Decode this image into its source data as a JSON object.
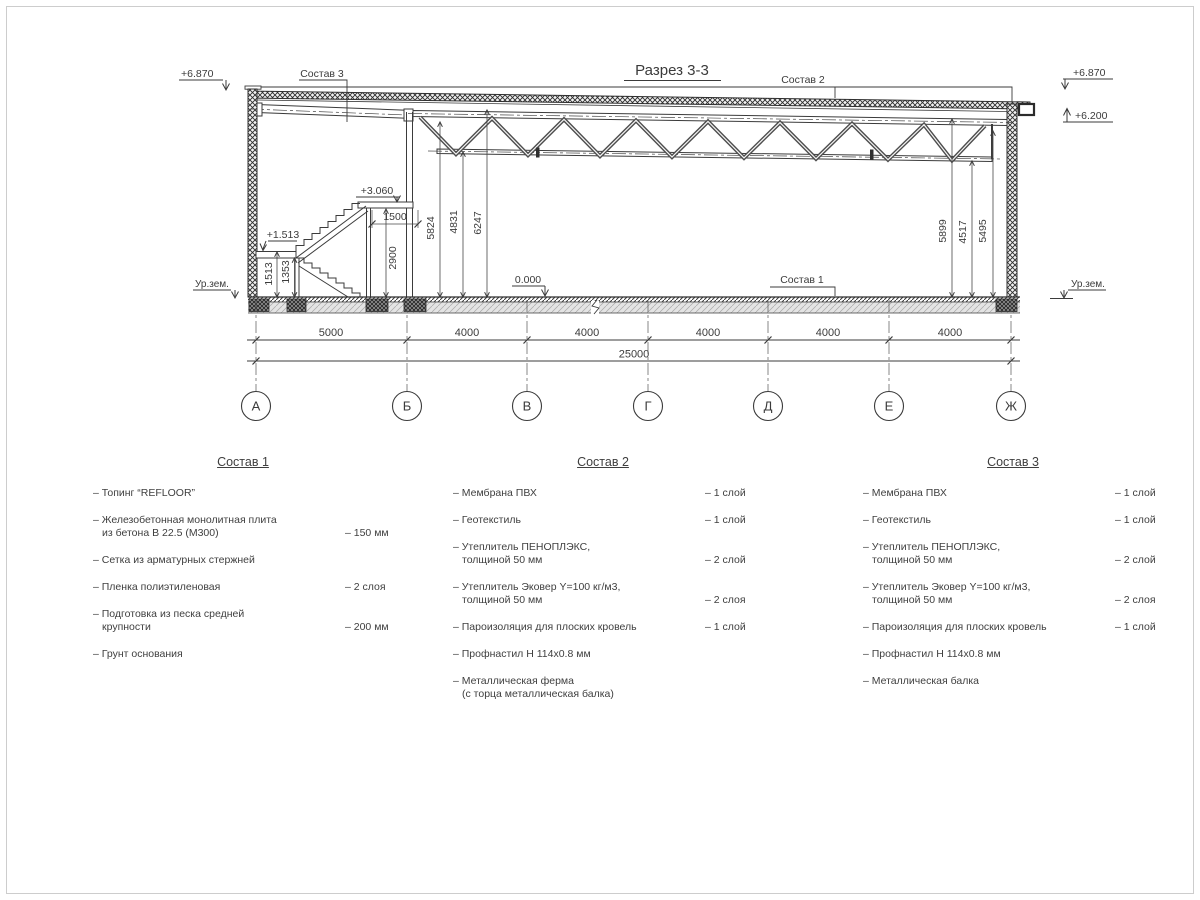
{
  "drawing": {
    "title": "Разрез 3-3",
    "elev_left_top": "+6.870",
    "elev_right_top": "+6.870",
    "elev_right_low": "+6.200",
    "elev_mezzanine": "+3.060",
    "elev_landing": "+1.513",
    "elev_floor": "0.000",
    "ground_label_left": "Ур.зем.",
    "ground_label_right": "Ур.зем.",
    "leader1": "Состав 1",
    "leader2": "Состав 2",
    "leader3": "Состав 3",
    "dim_1513": "1513",
    "dim_1353": "1353",
    "dim_2900": "2900",
    "dim_1500": "1500",
    "dim_5824": "5824",
    "dim_4831": "4831",
    "dim_6247": "6247",
    "dim_5899": "5899",
    "dim_4517": "4517",
    "dim_5495": "5495",
    "span_dims": [
      "5000",
      "4000",
      "4000",
      "4000",
      "4000",
      "4000"
    ],
    "total_dim": "25000",
    "axes": [
      "А",
      "Б",
      "В",
      "Г",
      "Д",
      "Е",
      "Ж"
    ]
  },
  "specs": [
    {
      "title": "Состав 1",
      "items": [
        {
          "lines": [
            "– Топинг “REFLOOR”"
          ],
          "value": ""
        },
        {
          "lines": [
            "– Железобетонная  монолитная плита",
            "из бетона В 22.5 (М300)"
          ],
          "value": "– 150 мм"
        },
        {
          "lines": [
            "– Сетка из арматурных стержней"
          ],
          "value": ""
        },
        {
          "lines": [
            "– Пленка полиэтиленовая"
          ],
          "value": "– 2 слоя"
        },
        {
          "lines": [
            "– Подготовка из песка средней",
            "крупности"
          ],
          "value": "– 200 мм"
        },
        {
          "lines": [
            "– Грунт основания"
          ],
          "value": ""
        }
      ]
    },
    {
      "title": "Состав 2",
      "items": [
        {
          "lines": [
            "– Мембрана ПВХ"
          ],
          "value": "– 1 слой"
        },
        {
          "lines": [
            "– Геотекстиль"
          ],
          "value": "– 1 слой"
        },
        {
          "lines": [
            "– Утеплитель ПЕНОПЛЭКС,",
            "толщиной 50 мм"
          ],
          "value": "– 2 слой"
        },
        {
          "lines": [
            "– Утеплитель Эковер Y=100 кг/м3,",
            "толщиной 50 мм"
          ],
          "value": "– 2 слоя"
        },
        {
          "lines": [
            "– Пароизоляция для плоских кровель"
          ],
          "value": "– 1 слой"
        },
        {
          "lines": [
            "– Профнастил Н 114х0.8 мм"
          ],
          "value": ""
        },
        {
          "lines": [
            "– Металлическая ферма",
            "(с торца металлическая балка)"
          ],
          "value": ""
        }
      ]
    },
    {
      "title": "Состав 3",
      "items": [
        {
          "lines": [
            "– Мембрана ПВХ"
          ],
          "value": "– 1 слой"
        },
        {
          "lines": [
            "– Геотекстиль"
          ],
          "value": "– 1 слой"
        },
        {
          "lines": [
            "– Утеплитель ПЕНОПЛЭКС,",
            "толщиной 50 мм"
          ],
          "value": "– 2 слой"
        },
        {
          "lines": [
            "– Утеплитель Эковер Y=100 кг/м3,",
            "толщиной 50 мм"
          ],
          "value": "– 2 слоя"
        },
        {
          "lines": [
            "– Пароизоляция для плоских кровель"
          ],
          "value": "– 1 слой"
        },
        {
          "lines": [
            "– Профнастил Н 114х0.8 мм"
          ],
          "value": ""
        },
        {
          "lines": [
            "– Металлическая балка"
          ],
          "value": ""
        }
      ]
    }
  ]
}
